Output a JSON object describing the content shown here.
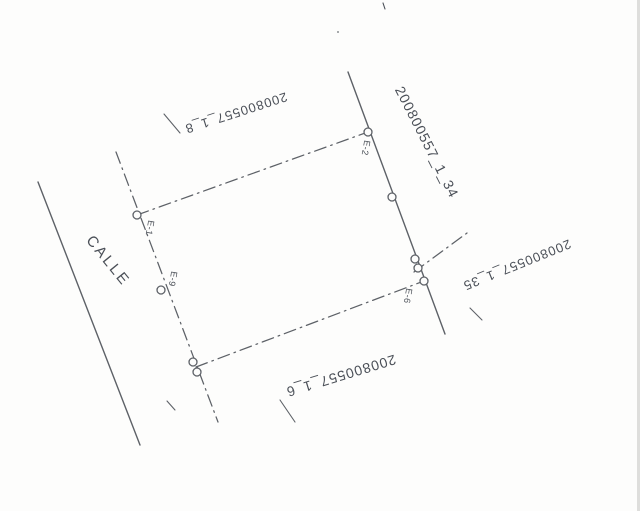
{
  "colors": {
    "paper": "#fdfdfc",
    "ink": "#4a4f57",
    "line": "#5d6167",
    "scan-edge": "#d6d6d3"
  },
  "street": {
    "name": "CALLE"
  },
  "parcels": {
    "top": "200800557_1_8",
    "right": "200800557_1_34",
    "mid_right": "200800557_1_35",
    "bottom": "200800557_1_6"
  },
  "points": {
    "e1": "E-1",
    "e2": "E-2",
    "e6": "E-6",
    "e9": "E-9"
  }
}
